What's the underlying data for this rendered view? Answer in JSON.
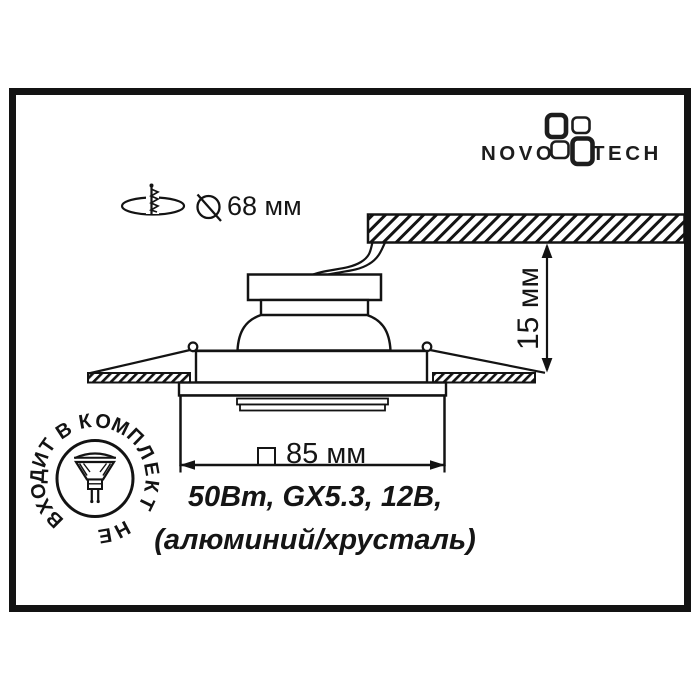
{
  "brand": {
    "name": "NOVOTECH",
    "wordmark_left": "NOVO",
    "wordmark_right": "TECH"
  },
  "cutout_note": {
    "diameter_label": "68 мм"
  },
  "depth_dimension": {
    "label": "15 мм"
  },
  "width_dimension": {
    "label": "85 мм"
  },
  "specs": {
    "line1": "50Вт, GX5.3, 12В,",
    "line2": "(алюминий/хрусталь)"
  },
  "stamp": {
    "ring_text": "НЕ ВХОДИТ В КОМПЛЕКТ"
  },
  "colors": {
    "ink": "#151515",
    "background": "#ffffff"
  }
}
